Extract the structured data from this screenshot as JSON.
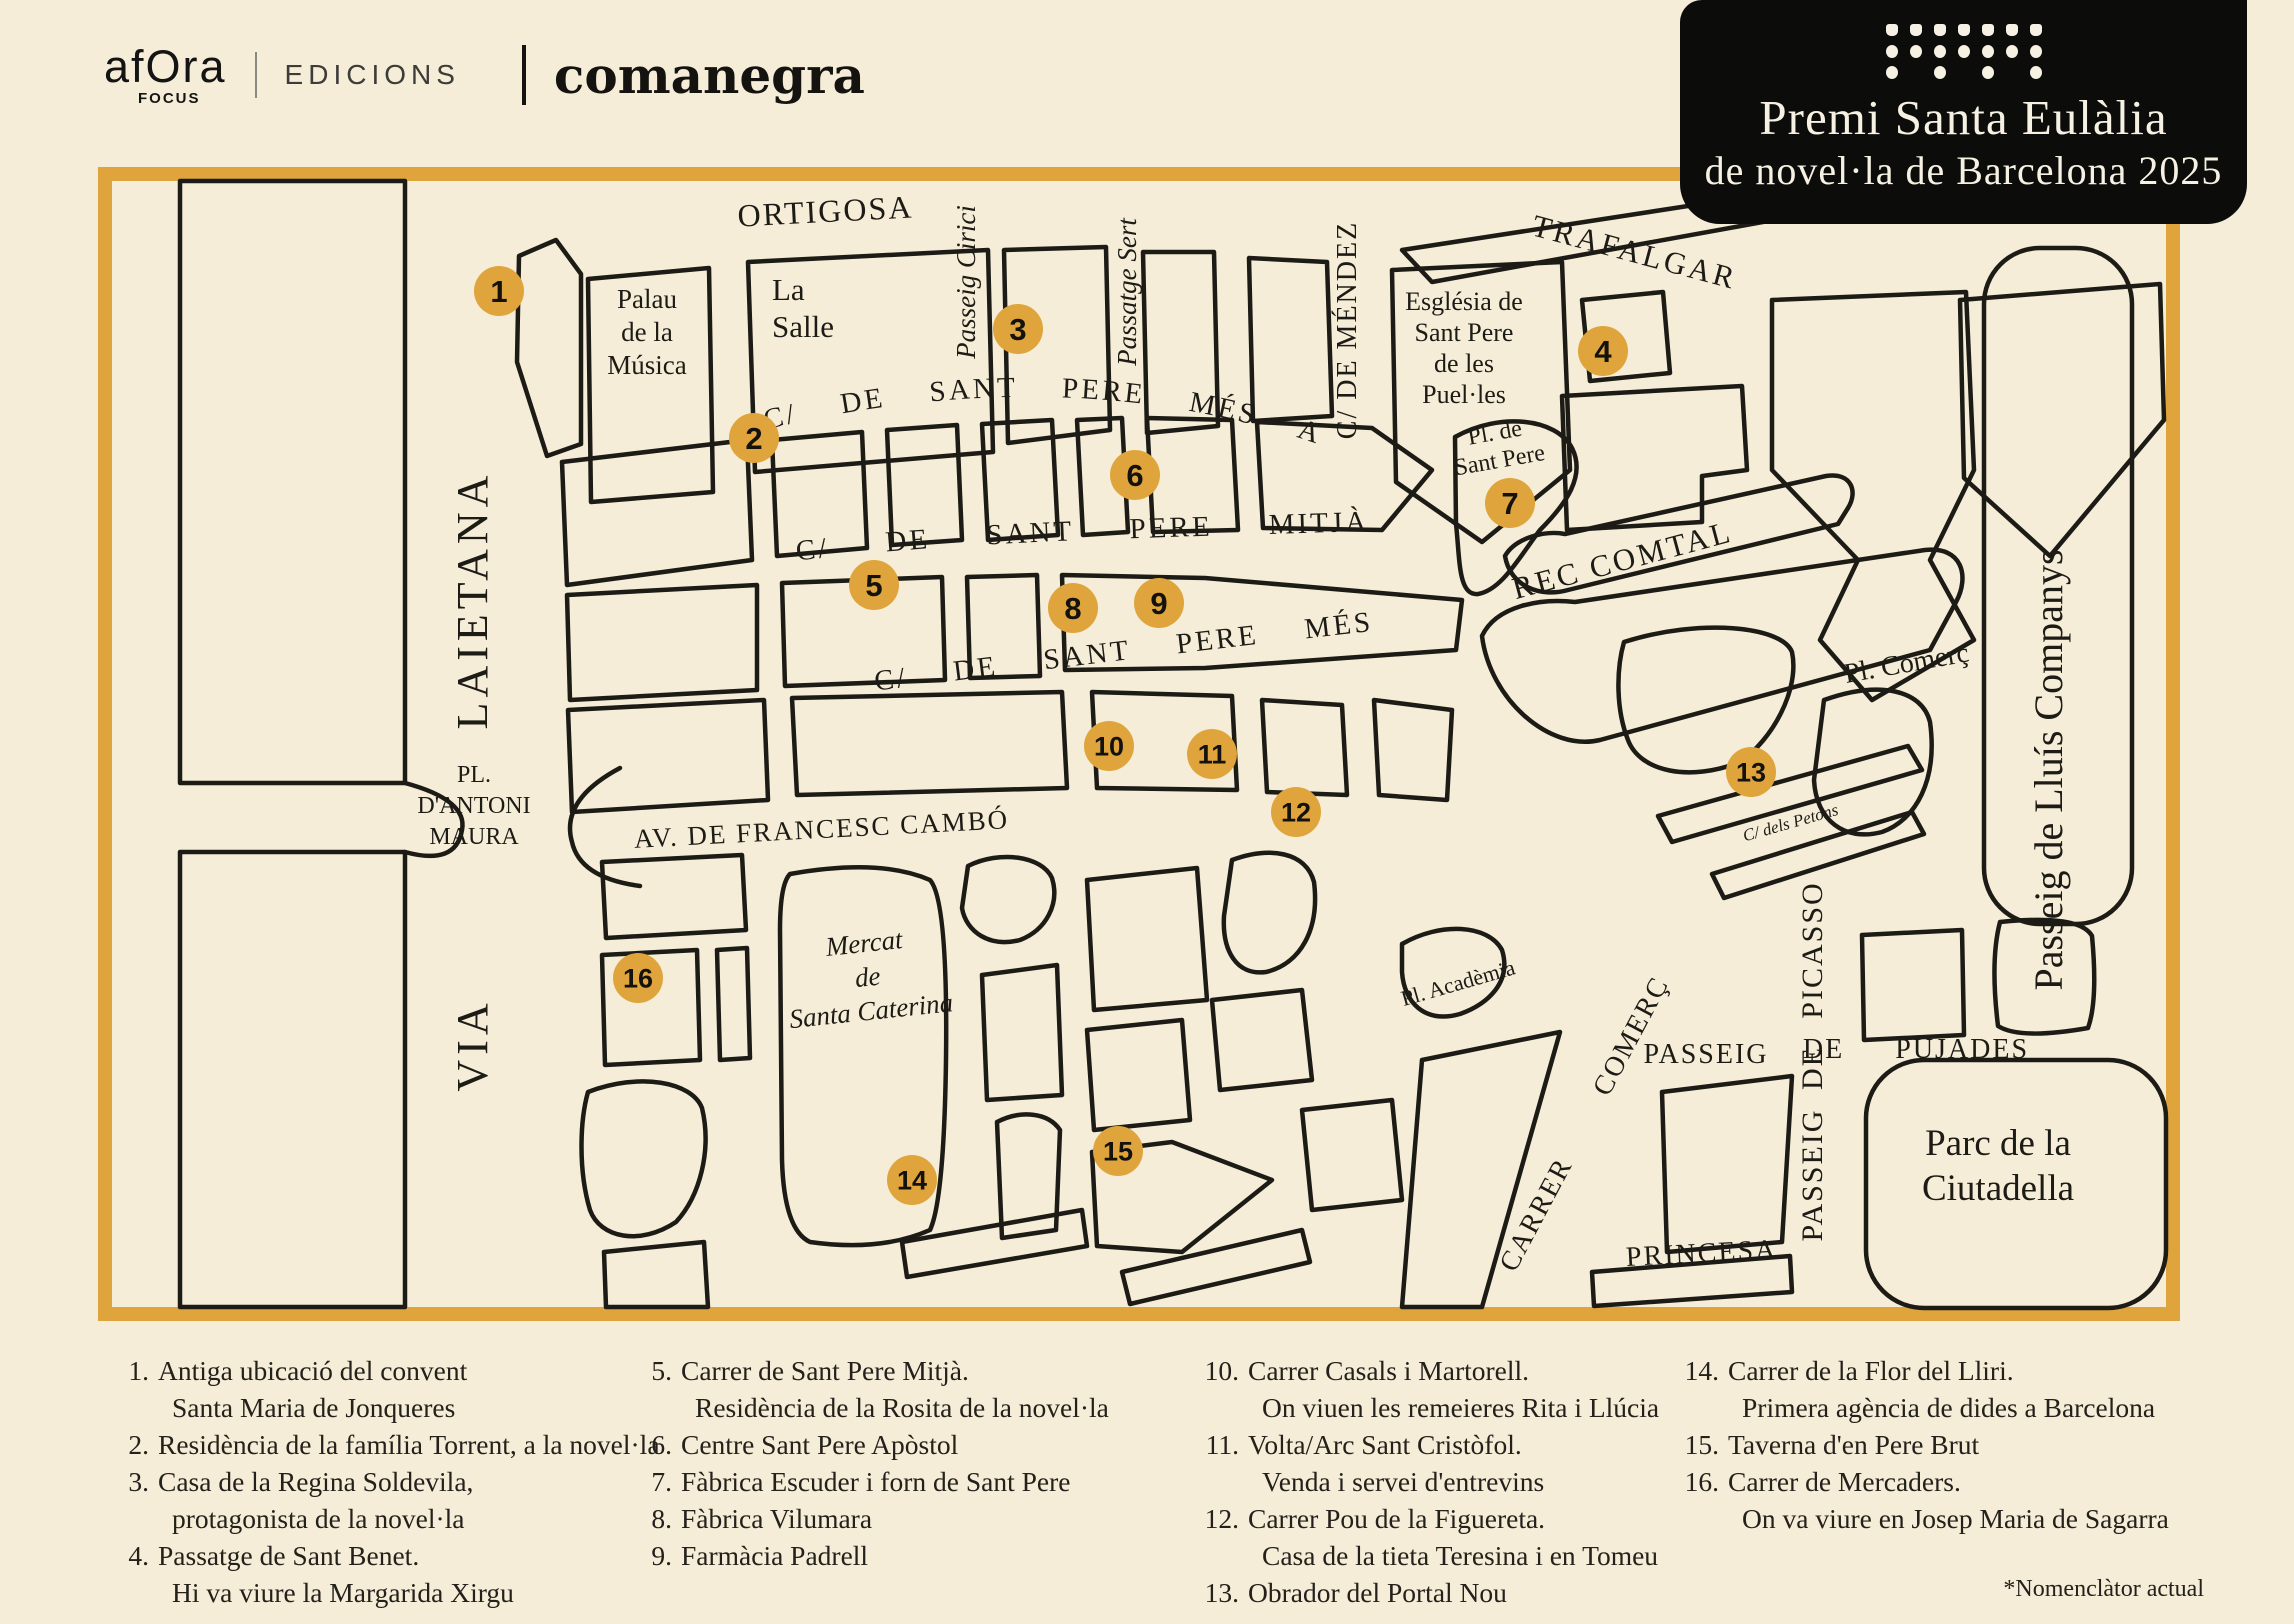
{
  "header": {
    "publisher_name": "afOra",
    "publisher_sub": "FOCUS",
    "publisher_suffix": "EDICIONS",
    "partner_name": "comanegra"
  },
  "badge": {
    "title_line1": "Premi Santa Eulàlia",
    "title_line2": "de novel·la de Barcelona 2025",
    "dots_pattern": [
      [
        1,
        1,
        1,
        1,
        1,
        1,
        1
      ],
      [
        2,
        2,
        2,
        2,
        2,
        2,
        2
      ],
      [
        2,
        0,
        2,
        0,
        2,
        0,
        2
      ]
    ]
  },
  "colors": {
    "background": "#f5edd7",
    "gold": "#dfa53c",
    "ink": "#1d1b16",
    "badge_bg": "#0c0c0b",
    "badge_text": "#f6f1e2"
  },
  "map": {
    "markers": [
      {
        "n": "1",
        "x": 499,
        "y": 291
      },
      {
        "n": "2",
        "x": 754,
        "y": 438
      },
      {
        "n": "3",
        "x": 1018,
        "y": 329
      },
      {
        "n": "4",
        "x": 1603,
        "y": 351
      },
      {
        "n": "5",
        "x": 874,
        "y": 585
      },
      {
        "n": "6",
        "x": 1135,
        "y": 475
      },
      {
        "n": "7",
        "x": 1510,
        "y": 503
      },
      {
        "n": "8",
        "x": 1073,
        "y": 608
      },
      {
        "n": "9",
        "x": 1159,
        "y": 603
      },
      {
        "n": "10",
        "x": 1109,
        "y": 746
      },
      {
        "n": "11",
        "x": 1212,
        "y": 754
      },
      {
        "n": "12",
        "x": 1296,
        "y": 812
      },
      {
        "n": "13",
        "x": 1751,
        "y": 772
      },
      {
        "n": "14",
        "x": 912,
        "y": 1180
      },
      {
        "n": "15",
        "x": 1118,
        "y": 1151
      },
      {
        "n": "16",
        "x": 638,
        "y": 978
      }
    ],
    "street_labels": [
      {
        "id": "ortigosa",
        "text": "ORTIGOSA",
        "x": 826,
        "y": 222,
        "size": 32,
        "rot": -3,
        "ls": 2
      },
      {
        "id": "trafalgar",
        "text": "TRAFALGAR",
        "x": 1632,
        "y": 262,
        "size": 31,
        "rot": 15,
        "ls": 3
      },
      {
        "id": "passeig-cirici",
        "text": "Passeig Cirici",
        "x": 975,
        "y": 282,
        "size": 27,
        "rot": -90,
        "cls": "it"
      },
      {
        "id": "passatge-sert",
        "text": "Passatge Sert",
        "x": 1136,
        "y": 292,
        "size": 27,
        "rot": -90,
        "cls": "it"
      },
      {
        "id": "c-de-mendez",
        "text": "C/ DE MÉNDEZ",
        "x": 1356,
        "y": 330,
        "size": 28,
        "rot": -90,
        "ls": 2
      },
      {
        "id": "sant-pere-mes-alt",
        "text": "C/ DE SANT PERE MÉS ALT",
        "pathId": "curveAlt",
        "size": 29,
        "ls": 3,
        "ws": 34
      },
      {
        "id": "sant-pere-mitja",
        "text": "C/ DE SANT PERE MITJÀ",
        "pathId": "curveMitja",
        "size": 29,
        "ls": 3,
        "ws": 46
      },
      {
        "id": "sant-pere-mes-baix",
        "text": "C/ DE SANT PERE MÉS BAIX",
        "pathId": "curveBaix",
        "size": 29,
        "ls": 3,
        "ws": 36
      },
      {
        "id": "laietana",
        "text": "LAIETANA",
        "x": 487,
        "y": 600,
        "size": 44,
        "rot": -90,
        "ls": 5
      },
      {
        "id": "via",
        "text": "VIA",
        "x": 487,
        "y": 1045,
        "size": 44,
        "rot": -90,
        "ls": 5
      },
      {
        "id": "av-cambo",
        "text": "AV. DE FRANCESC CAMBÓ",
        "x": 822,
        "y": 838,
        "size": 27,
        "rot": -3,
        "ls": 2
      },
      {
        "id": "rec-comtal",
        "text": "REC COMTAL",
        "x": 1625,
        "y": 570,
        "size": 31,
        "rot": -15,
        "ls": 3
      },
      {
        "id": "pl-comerc",
        "text": "Pl. Comerç",
        "x": 1908,
        "y": 672,
        "size": 28,
        "rot": -10
      },
      {
        "id": "c-dels-petons",
        "text": "C/ dels Petons",
        "x": 1792,
        "y": 828,
        "size": 17,
        "rot": -16,
        "cls": "it"
      },
      {
        "id": "passeig-lluis-companys",
        "text": "Passeig de Lluís Companys",
        "x": 2062,
        "y": 770,
        "size": 40,
        "rot": -90
      },
      {
        "id": "picasso",
        "text": "PICASSO",
        "x": 1822,
        "y": 950,
        "size": 30,
        "rot": -90,
        "ls": 2
      },
      {
        "id": "de-vertical",
        "text": "DE",
        "x": 1822,
        "y": 1068,
        "size": 30,
        "rot": -90,
        "ls": 2
      },
      {
        "id": "passeig-vertical",
        "text": "PASSEIG",
        "x": 1822,
        "y": 1175,
        "size": 30,
        "rot": -90,
        "ls": 2
      },
      {
        "id": "passeig-horizontal",
        "text": "PASSEIG",
        "x": 1706,
        "y": 1063,
        "size": 28,
        "rot": 0,
        "ls": 2
      },
      {
        "id": "de-pujades",
        "text": "DE PUJADES",
        "x": 1916,
        "y": 1058,
        "size": 28,
        "rot": 0,
        "ls": 2,
        "ws": 42
      },
      {
        "id": "princesa",
        "text": "PRINCESA",
        "x": 1702,
        "y": 1262,
        "size": 28,
        "rot": -3,
        "ls": 2
      },
      {
        "id": "carrer-comerc",
        "text": "CARRER COMERÇ",
        "x": 1592,
        "y": 1128,
        "size": 28,
        "rot": -62,
        "ls": 2,
        "ws": 66
      },
      {
        "id": "pl-academia",
        "text": "Pl. Acadèmia",
        "x": 1460,
        "y": 990,
        "size": 22,
        "rot": -16
      }
    ],
    "place_labels": [
      {
        "id": "palau-musica",
        "lines": [
          "Palau",
          "de la",
          "Música"
        ],
        "x": 647,
        "y": 308,
        "size": 27,
        "lh": 33
      },
      {
        "id": "la-salle",
        "lines": [
          "La",
          "Salle"
        ],
        "x": 772,
        "y": 300,
        "size": 31,
        "lh": 37,
        "anchor": "start"
      },
      {
        "id": "esglesia-sant-pere",
        "lines": [
          "Església de",
          "Sant Pere",
          "de les",
          "Puel·les"
        ],
        "x": 1464,
        "y": 310,
        "size": 26,
        "lh": 31
      },
      {
        "id": "pl-de-sant-pere",
        "lines": [
          "Pl. de",
          "Sant Pere"
        ],
        "x": 1496,
        "y": 440,
        "size": 24,
        "lh": 28,
        "rot": -10
      },
      {
        "id": "pl-antoni-maura",
        "lines": [
          "PL.",
          "D'ANTONI",
          "MAURA"
        ],
        "x": 474,
        "y": 782,
        "size": 24,
        "lh": 31
      },
      {
        "id": "mercat-santa-caterina",
        "lines": [
          "Mercat",
          "de",
          "Santa Caterina"
        ],
        "x": 865,
        "y": 952,
        "size": 27,
        "lh": 34,
        "rot": -6,
        "cls": "it"
      },
      {
        "id": "parc-ciutadella",
        "lines": [
          "Parc de la",
          "Ciutadella"
        ],
        "x": 1998,
        "y": 1155,
        "size": 37,
        "lh": 45
      }
    ]
  },
  "legend": {
    "columns": [
      {
        "items": [
          {
            "num": "1.",
            "lines": [
              "Antiga ubicació del convent",
              "Santa Maria de Jonqueres"
            ]
          },
          {
            "num": "2.",
            "lines": [
              "Residència de la família Torrent, a la novel·la"
            ]
          },
          {
            "num": "3.",
            "lines": [
              "Casa de la Regina Soldevila,",
              "protagonista de la novel·la"
            ]
          },
          {
            "num": "4.",
            "lines": [
              "Passatge de Sant Benet.",
              "Hi va viure la Margarida Xirgu"
            ]
          }
        ]
      },
      {
        "items": [
          {
            "num": "5.",
            "lines": [
              "Carrer de Sant Pere Mitjà.",
              "Residència de la Rosita de la novel·la"
            ]
          },
          {
            "num": "6.",
            "lines": [
              "Centre Sant Pere Apòstol"
            ]
          },
          {
            "num": "7.",
            "lines": [
              "Fàbrica Escuder i forn de Sant Pere"
            ]
          },
          {
            "num": "8.",
            "lines": [
              "Fàbrica Vilumara"
            ]
          },
          {
            "num": "9.",
            "lines": [
              "Farmàcia Padrell"
            ]
          }
        ]
      },
      {
        "items": [
          {
            "num": "10.",
            "lines": [
              "Carrer Casals i Martorell.",
              "On viuen les remeieres Rita i Llúcia"
            ]
          },
          {
            "num": "11.",
            "lines": [
              "Volta/Arc Sant Cristòfol.",
              "Venda i servei d'entrevins"
            ]
          },
          {
            "num": "12.",
            "lines": [
              "Carrer Pou de la Figuereta.",
              "Casa de la tieta Teresina i en Tomeu"
            ]
          },
          {
            "num": "13.",
            "lines": [
              "Obrador del Portal Nou"
            ]
          }
        ]
      },
      {
        "items": [
          {
            "num": "14.",
            "lines": [
              "Carrer de la Flor del Lliri.",
              "Primera agència de dides a Barcelona"
            ]
          },
          {
            "num": "15.",
            "lines": [
              "Taverna d'en Pere Brut"
            ]
          },
          {
            "num": "16.",
            "lines": [
              "Carrer de Mercaders.",
              "On va viure en Josep Maria de Sagarra"
            ]
          }
        ]
      }
    ],
    "footnote": "*Nomenclàtor actual"
  }
}
